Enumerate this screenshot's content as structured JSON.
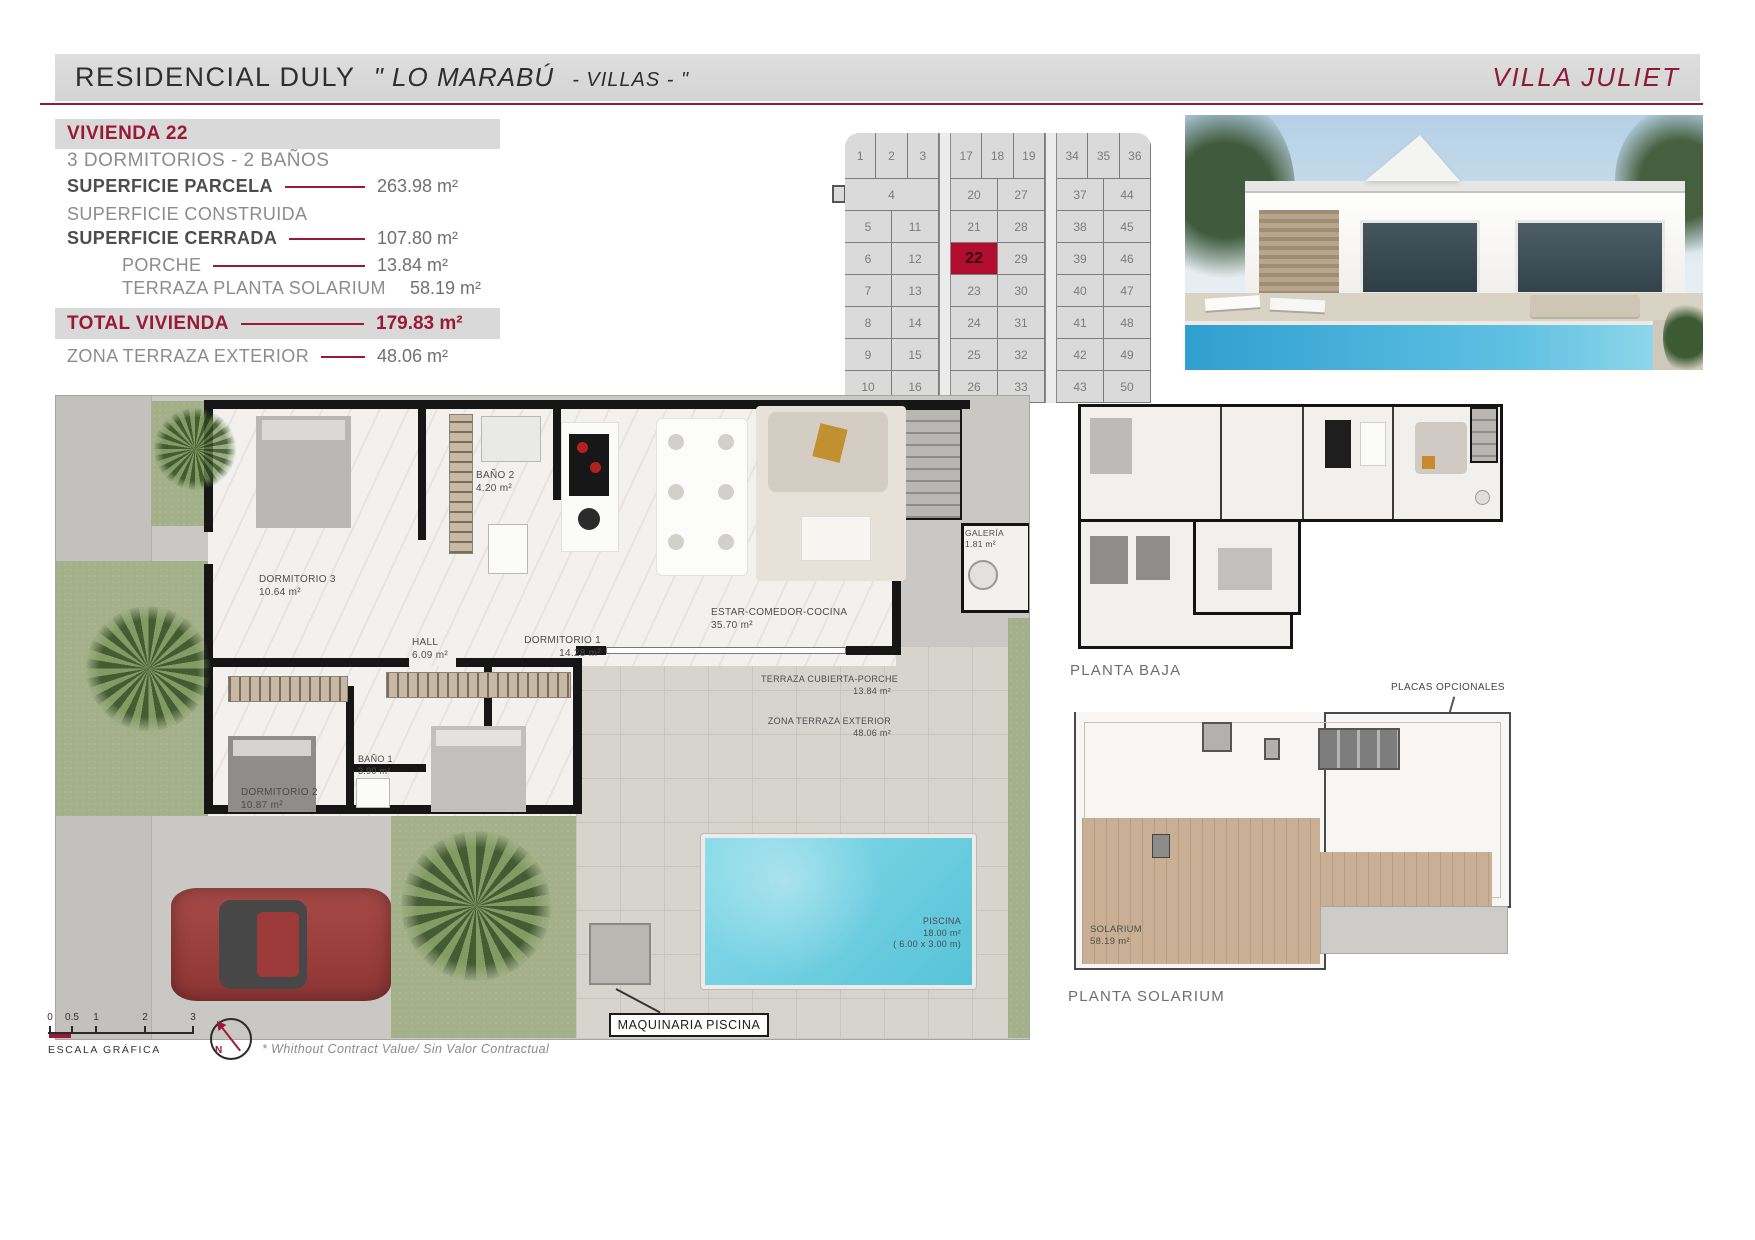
{
  "header": {
    "title": "RESIDENCIAL DULY",
    "project": "\" LO MARABÚ",
    "project_small": "- VILLAS - \"",
    "villa": "VILLA JULIET"
  },
  "info": {
    "vivienda": "VIVIENDA 22",
    "rooms": "3 DORMITORIOS - 2 BAÑOS",
    "rows": [
      {
        "label": "SUPERFICIE PARCELA",
        "value": "263.98 m²"
      },
      {
        "label": "SUPERFICIE CONSTRUIDA",
        "value": ""
      },
      {
        "label": "SUPERFICIE CERRADA",
        "value": "107.80 m²"
      },
      {
        "label": "PORCHE",
        "value": "13.84 m²"
      },
      {
        "label": "TERRAZA PLANTA SOLARIUM",
        "value": "58.19 m²"
      }
    ],
    "total_label": "TOTAL VIVIENDA",
    "total_value": "179.83 m²",
    "zona_label": "ZONA TERRAZA EXTERIOR",
    "zona_value": "48.06 m²"
  },
  "site_map": {
    "highlighted": "22",
    "blocks": [
      {
        "top": [
          "1",
          "2",
          "3"
        ],
        "rows": [
          [
            "4"
          ],
          [
            "5",
            "11"
          ],
          [
            "6",
            "12"
          ],
          [
            "7",
            "13"
          ],
          [
            "8",
            "14"
          ],
          [
            "9",
            "15"
          ],
          [
            "10",
            "16"
          ]
        ]
      },
      {
        "top": [
          "17",
          "18",
          "19"
        ],
        "rows": [
          [
            "20",
            "27"
          ],
          [
            "21",
            "28"
          ],
          [
            "22",
            "29"
          ],
          [
            "23",
            "30"
          ],
          [
            "24",
            "31"
          ],
          [
            "25",
            "32"
          ],
          [
            "26",
            "33"
          ]
        ]
      },
      {
        "top": [
          "34",
          "35",
          "36"
        ],
        "rows": [
          [
            "37",
            "44"
          ],
          [
            "38",
            "45"
          ],
          [
            "39",
            "46"
          ],
          [
            "40",
            "47"
          ],
          [
            "41",
            "48"
          ],
          [
            "42",
            "49"
          ],
          [
            "43",
            "50"
          ]
        ]
      }
    ]
  },
  "floor_plan": {
    "rooms": [
      {
        "name": "DORMITORIO 3",
        "area": "10.64 m²"
      },
      {
        "name": "BAÑO 2",
        "area": "4.20 m²"
      },
      {
        "name": "HALL",
        "area": "6.09 m²"
      },
      {
        "name": "ESTAR-COMEDOR-COCINA",
        "area": "35.70 m²"
      },
      {
        "name": "GALERÍA",
        "area": "1.81 m²"
      },
      {
        "name": "DORMITORIO 1",
        "area": "14.28 m²"
      },
      {
        "name": "DORMITORIO 2",
        "area": "10.87 m²"
      },
      {
        "name": "BAÑO 1",
        "area": "3.90 m²"
      },
      {
        "name": "TERRAZA CUBIERTA-PORCHE",
        "area": "13.84 m²"
      },
      {
        "name": "ZONA TERRAZA EXTERIOR",
        "area": "48.06 m²"
      },
      {
        "name": "PISCINA",
        "area": "18.00 m²",
        "dims": "( 6.00 x 3.00 m)"
      }
    ],
    "maquinaria_label": "MAQUINARIA PISCINA"
  },
  "plans": {
    "planta_baja_label": "PLANTA BAJA",
    "planta_solarium_label": "PLANTA SOLARIUM",
    "placas_label": "PLACAS OPCIONALES",
    "solarium_name": "SOLARIUM",
    "solarium_area": "58.19 m²"
  },
  "footer": {
    "scale_ticks": [
      "0",
      "0.5",
      "1",
      "2",
      "3"
    ],
    "escala_label": "ESCALA GRÁFICA",
    "north": "N",
    "note": "*  Whithout Contract Value/ Sin Valor Contractual"
  },
  "colors": {
    "accent": "#9A1A35",
    "highlight_cell": "#B30D2E",
    "header_gray": "#D9D9D9",
    "pool_water": "#7FD4E5",
    "grass": "#A3B089"
  }
}
